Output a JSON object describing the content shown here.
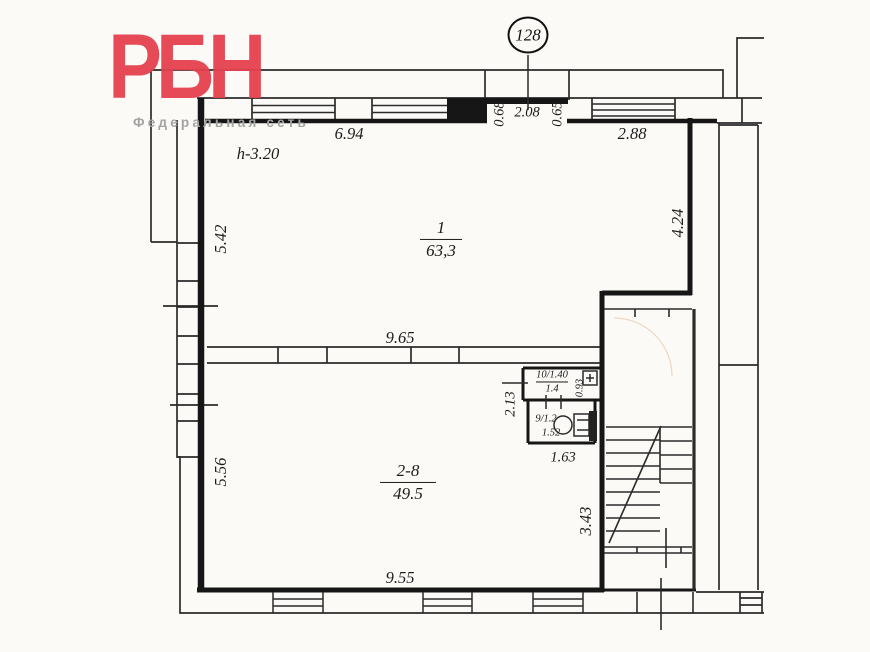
{
  "logo": {
    "brand": "РБН",
    "subtitle": "Федеральная сеть"
  },
  "badge": {
    "number": "128"
  },
  "rooms": [
    {
      "label_top": "1",
      "label_bottom": "63,3",
      "height_label": "h-3.20"
    },
    {
      "label_top": "2-8",
      "label_bottom": "49.5"
    },
    {
      "label_top": "10/1.40",
      "label_bottom": "1.4"
    },
    {
      "label_top": "9/1.2",
      "label_bottom": "1.52"
    }
  ],
  "dimensions": {
    "top_run": "6.94",
    "entry_left": "0.68",
    "entry_width": "2.08",
    "entry_right": "0.65",
    "top_right_run": "2.88",
    "left_upper": "5.42",
    "right_wall": "4.24",
    "partition": "9.65",
    "left_lower": "5.56",
    "wc_left": "2.13",
    "wc_shaft": "0.93",
    "wc_bottom": "1.63",
    "lower_right": "3.43",
    "bottom_run": "9.55"
  },
  "colors": {
    "line": "#2b2b2b",
    "wall": "#161616",
    "brand_red": "#e5414f",
    "subtitle_gray": "#a3a3a3"
  }
}
